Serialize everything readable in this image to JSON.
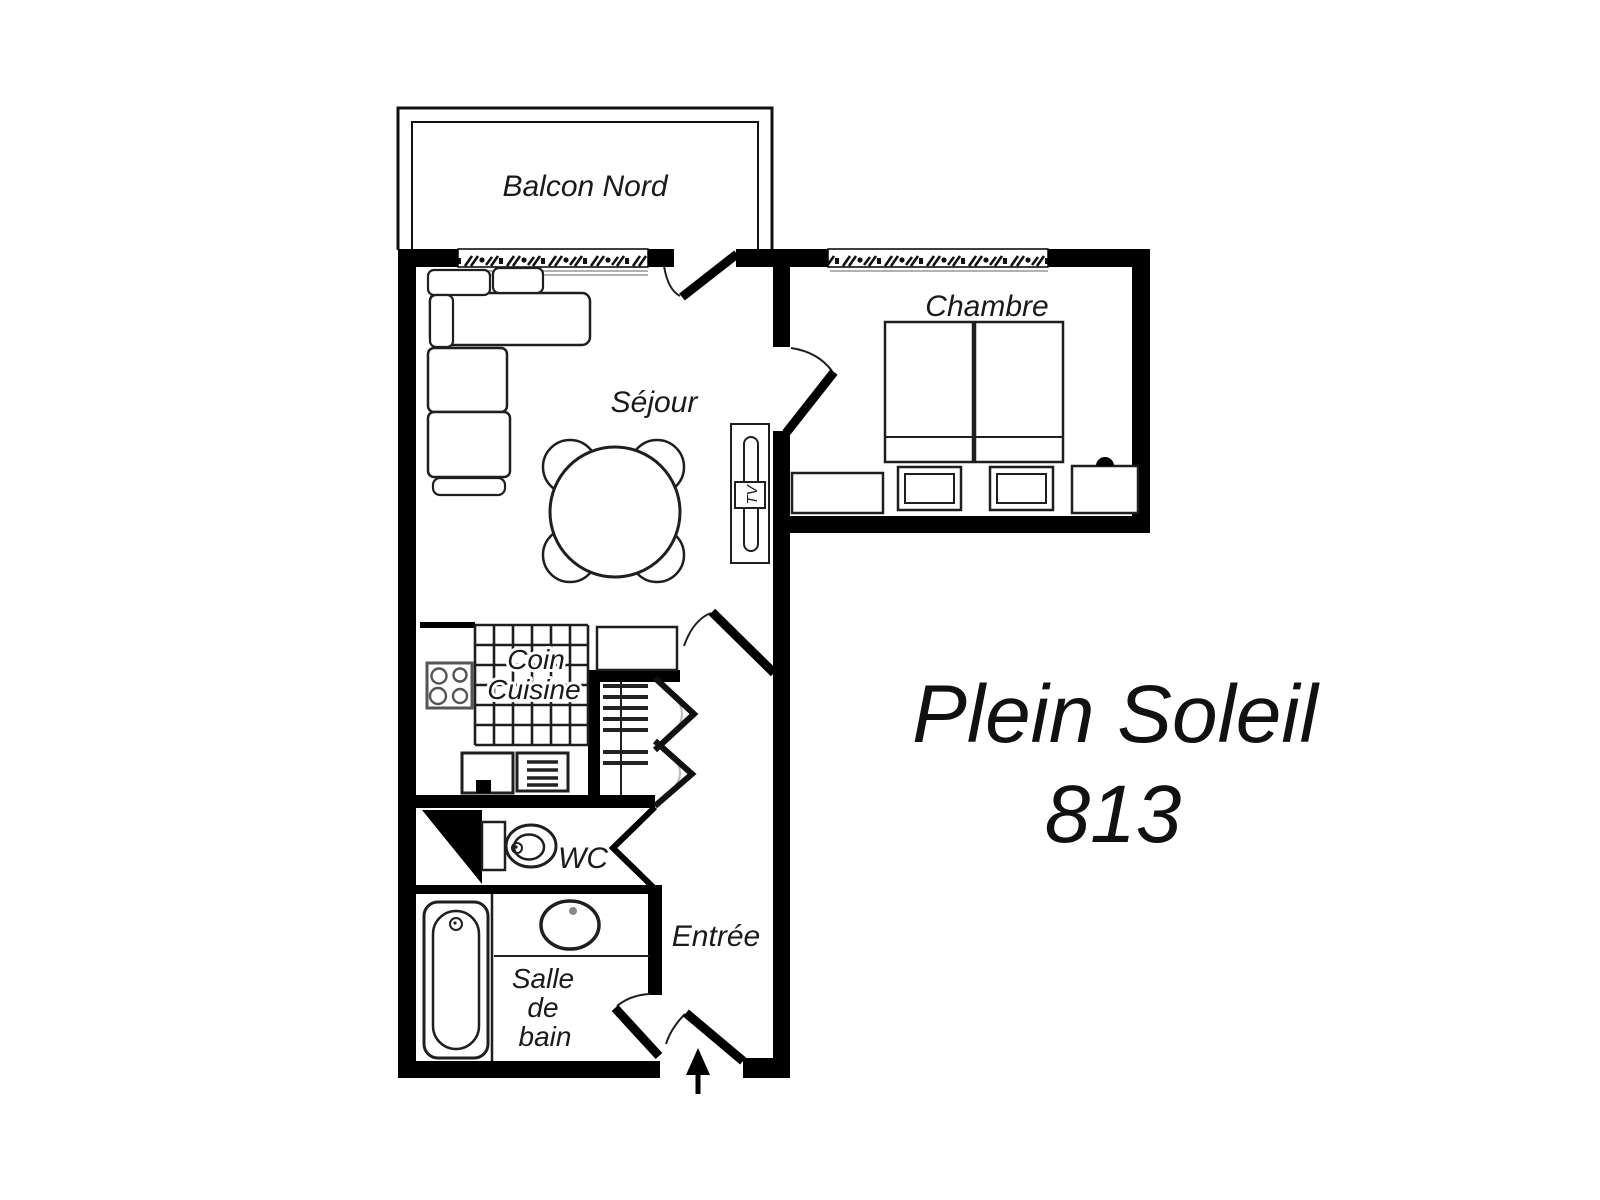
{
  "title": {
    "name": "Plein Soleil",
    "number": "813"
  },
  "labels": {
    "balcony": "Balcon Nord",
    "bedroom": "Chambre",
    "living_room": "Séjour",
    "kitchen_line1": "Coin",
    "kitchen_line2": "Cuisine",
    "wc": "WC",
    "bathroom_line1": "Salle",
    "bathroom_line2": "de",
    "bathroom_line3": "bain",
    "entry": "Entrée",
    "tv": "TV"
  },
  "colors": {
    "walls": "#000000",
    "background": "#ffffff",
    "lines": "#1f1f1f",
    "window_hatch": "#111111",
    "soft_gray": "#999999"
  }
}
